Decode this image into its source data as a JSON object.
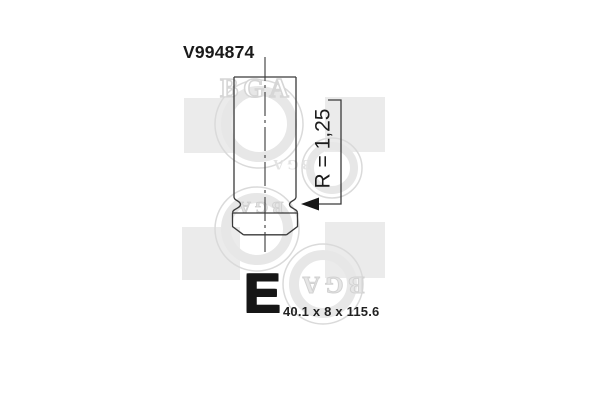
{
  "part": {
    "number": "V994874",
    "radius_label": "R = 1,25",
    "type_code": "E",
    "dimensions_label": "40.1 x 8 x 115.6"
  },
  "watermark": {
    "logo_text": "BGA"
  },
  "colors": {
    "drawing_line": "#3a3a3a",
    "text": "#1a1a1a",
    "arrow": "#161616",
    "watermark_square": "#ebebeb",
    "watermark_ring": "#dadada"
  }
}
